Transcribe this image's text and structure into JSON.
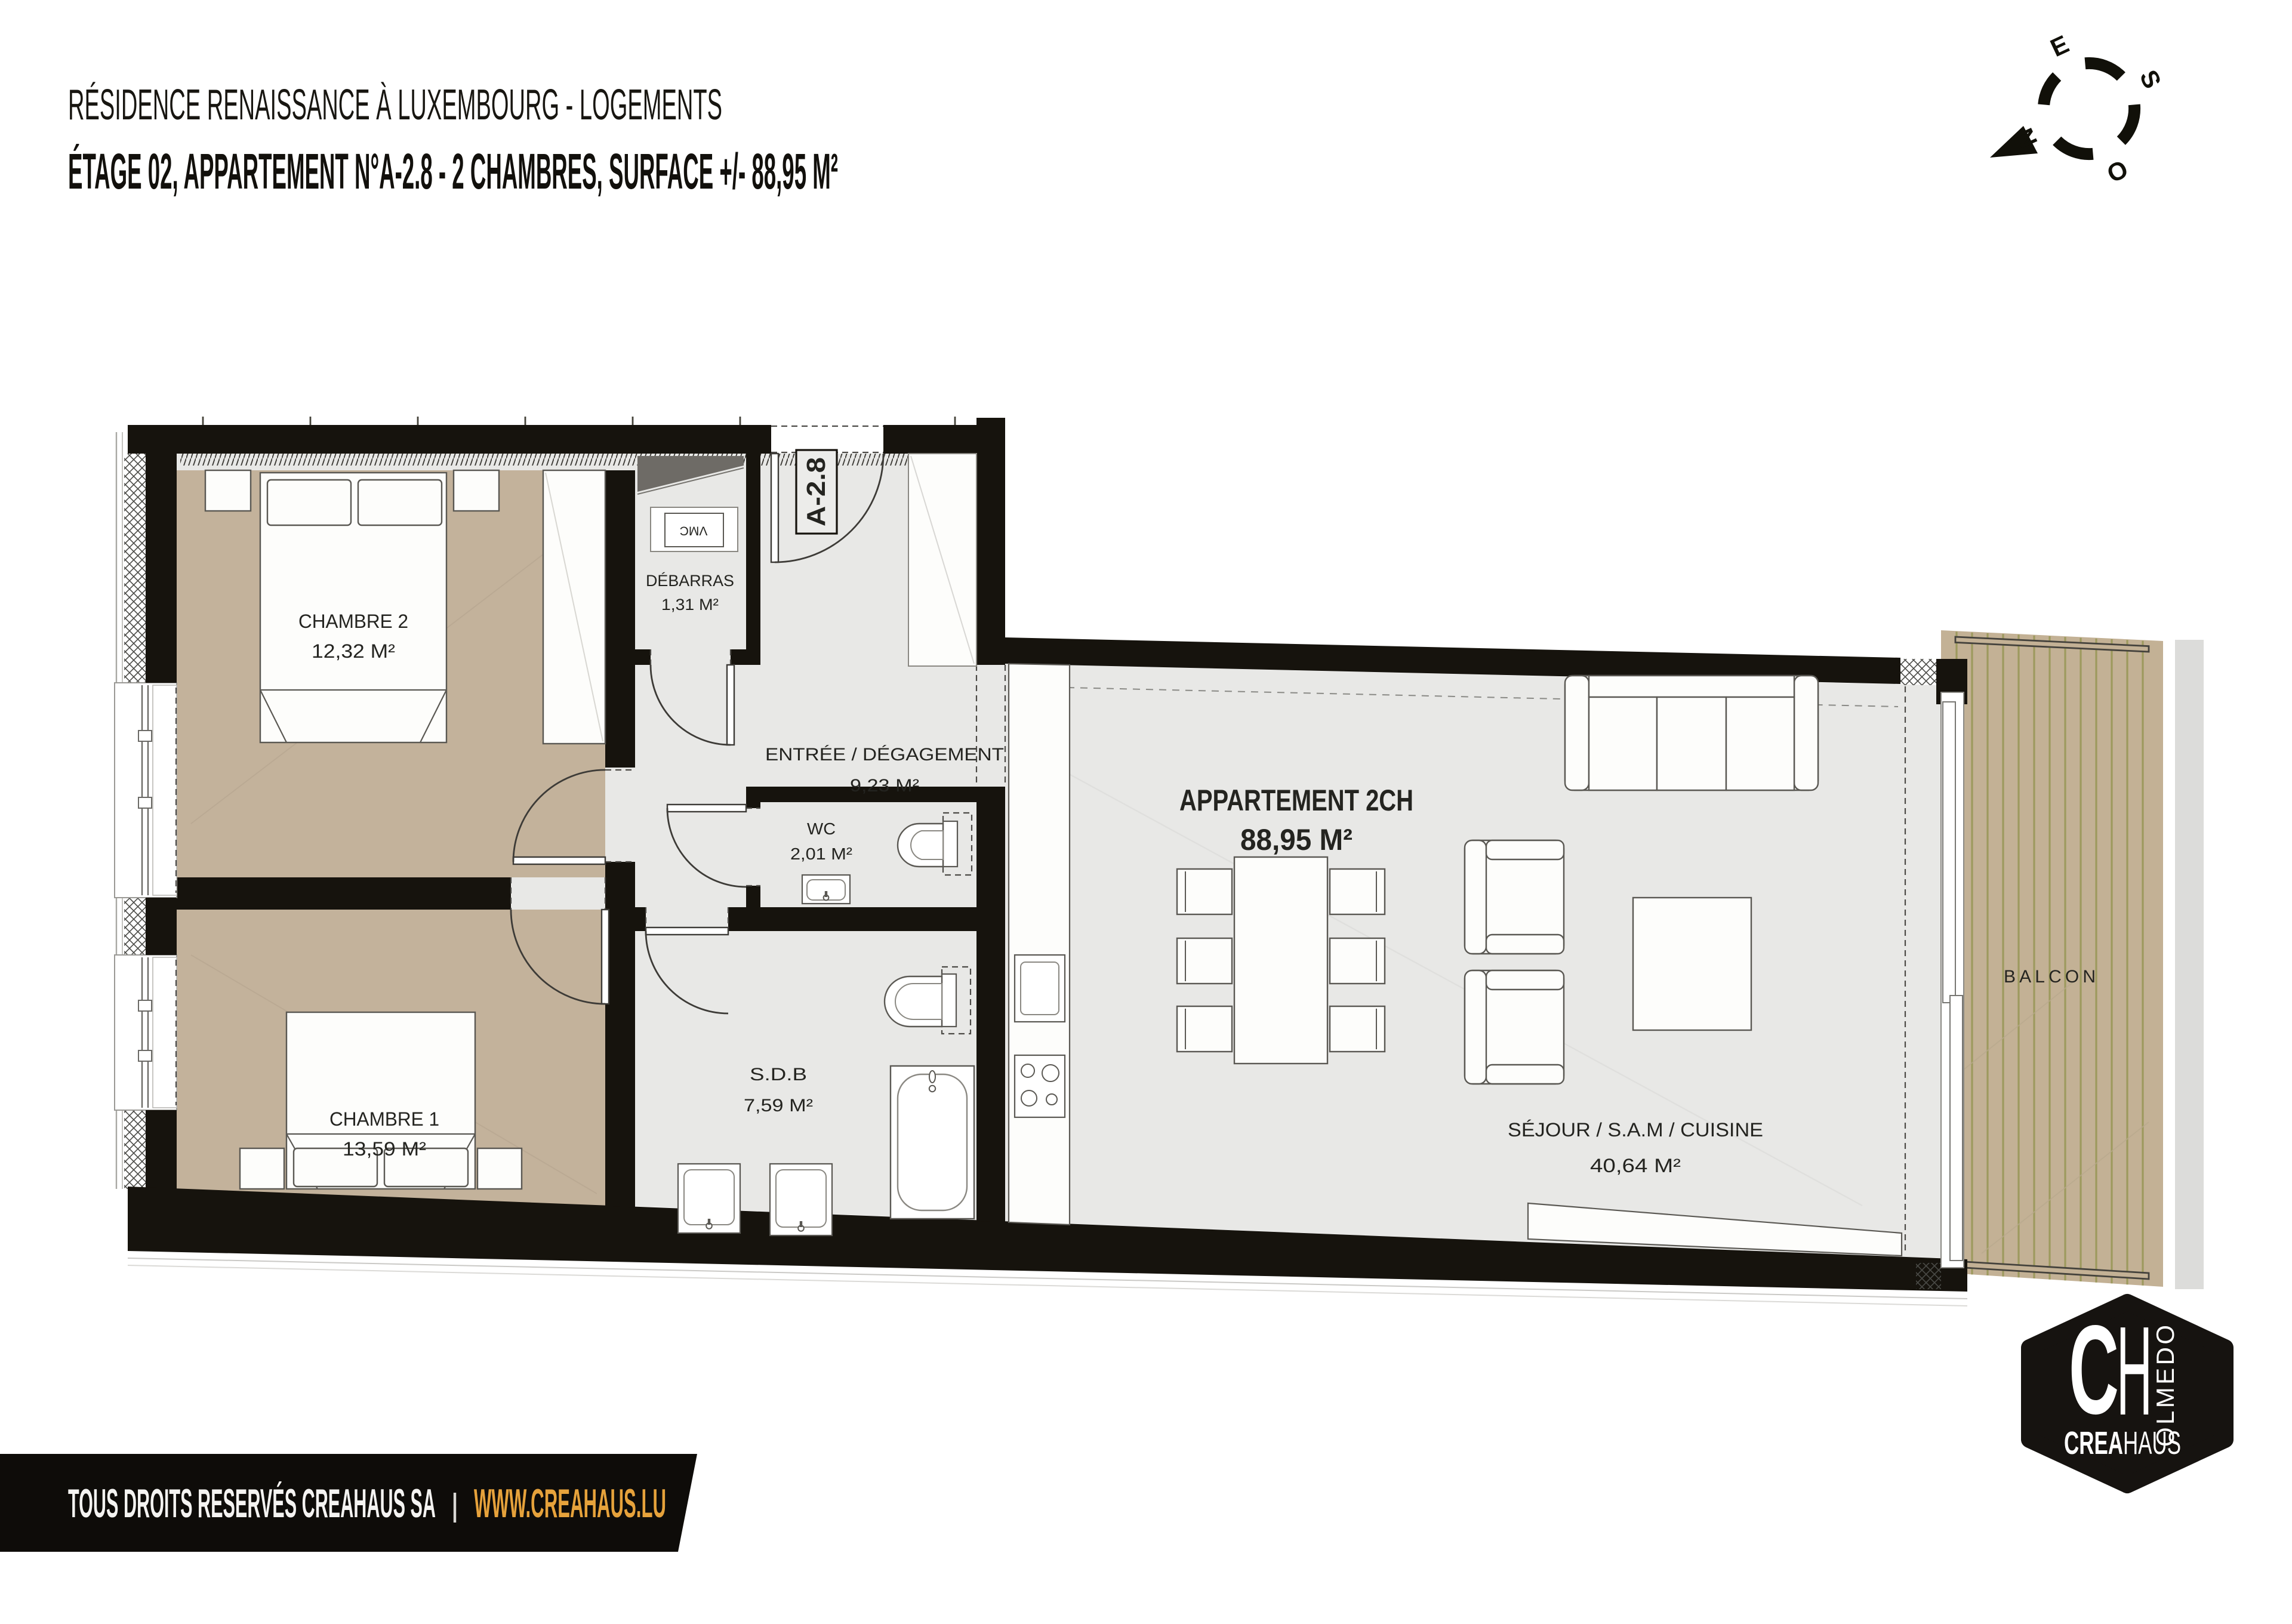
{
  "header": {
    "line1": "RÉSIDENCE RENAISSANCE À LUXEMBOURG - LOGEMENTS",
    "line2": "ÉTAGE 02, APPARTEMENT N°A-2.8 - 2 CHAMBRES, SURFACE +/- 88,95 M²"
  },
  "compass": {
    "n": "N",
    "e": "E",
    "s": "S",
    "o": "O"
  },
  "plan": {
    "unit_tag": "A-2.8",
    "vmc_label": "VMC",
    "apartment": {
      "name": "APPARTEMENT 2CH",
      "area": "88,95 M²"
    },
    "rooms": [
      {
        "name": "CHAMBRE 2",
        "area": "12,32 M²"
      },
      {
        "name": "DÉBARRAS",
        "area": "1,31 M²"
      },
      {
        "name": "ENTRÉE / DÉGAGEMENT",
        "area": "9,23 M²"
      },
      {
        "name": "WC",
        "area": "2,01 M²"
      },
      {
        "name": "S.D.B",
        "area": "7,59 M²"
      },
      {
        "name": "CHAMBRE 1",
        "area": "13,59 M²"
      },
      {
        "name": "SÉJOUR / S.A.M / CUISINE",
        "area": "40,64 M²"
      },
      {
        "name": "BALCON",
        "area": ""
      }
    ]
  },
  "footer": {
    "rights": "TOUS DROITS RESERVÉS CREAHAUS SA",
    "separator": "|",
    "website": "WWW.CREAHAUS.LU"
  },
  "logo": {
    "initial_c": "C",
    "initial_h": "H",
    "olmedo": "OLMEDO",
    "brand_bold": "CREA",
    "brand_light": "HAUS"
  },
  "colors": {
    "wall": "#16130d",
    "bedroom_floor": "#c3b29b",
    "common_floor": "#e8e8e6",
    "deck": "#c3b195",
    "deck_stripe": "#9d9a5e",
    "accent_gold": "#e6a23b",
    "footer_bg": "#0e0c09"
  }
}
